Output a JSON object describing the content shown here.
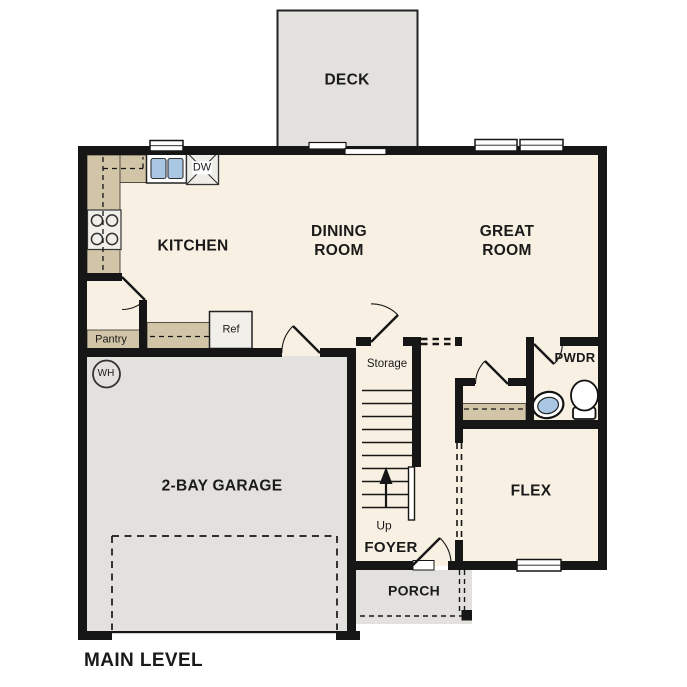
{
  "plan": {
    "title": "MAIN LEVEL",
    "labels": {
      "deck": "DECK",
      "kitchen": "KITCHEN",
      "dining_room": "DINING ROOM",
      "great_room": "GREAT ROOM",
      "garage": "2-BAY GARAGE",
      "flex": "FLEX",
      "foyer": "FOYER",
      "porch": "PORCH",
      "pwdr": "PWDR",
      "storage": "Storage",
      "pantry": "Pantry",
      "up": "Up",
      "ref": "Ref",
      "dw": "DW",
      "wh": "WH"
    },
    "colors": {
      "wall": "#161616",
      "floor": "#f8f0e2",
      "garage_floor": "#e3e1de",
      "deck_floor": "#e3e1de",
      "porch_floor": "#e3e1de",
      "counter": "#d2c4a7",
      "fixture_blue": "#a9c6e3"
    }
  }
}
